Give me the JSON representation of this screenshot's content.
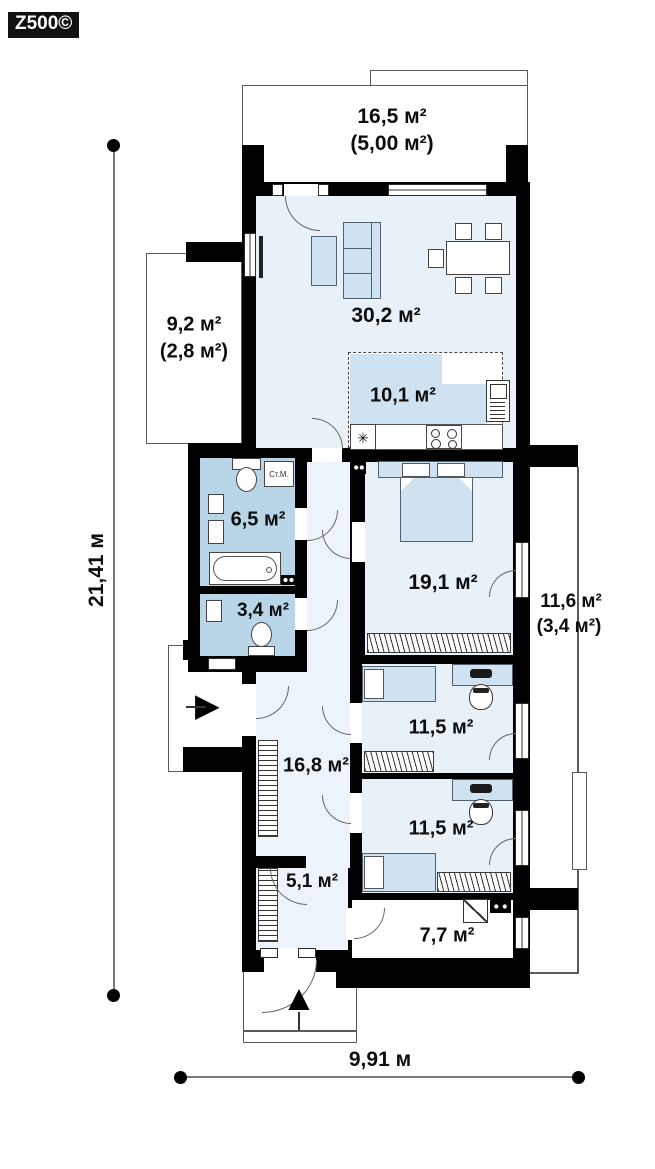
{
  "logo": {
    "text": "Z500©"
  },
  "dimensions": {
    "vertical": "21,41 м",
    "horizontal": "9,91 м"
  },
  "rooms": {
    "terrace_top": {
      "area": "16,5 м²",
      "area_secondary": "(5,00 м²)"
    },
    "terrace_left": {
      "area": "9,2 м²",
      "area_secondary": "(2,8 м²)"
    },
    "terrace_right": {
      "area": "11,6 м²",
      "area_secondary": "(3,4 м²)"
    },
    "living_room": {
      "area": "30,2 м²"
    },
    "kitchen": {
      "area": "10,1 м²"
    },
    "bathroom": {
      "area": "6,5 м²",
      "washing_machine": "Ст.М."
    },
    "wc": {
      "area": "3,4 м²"
    },
    "bedroom_main": {
      "area": "19,1 м²"
    },
    "bedroom_child_1": {
      "area": "11,5 м²"
    },
    "bedroom_child_2": {
      "area": "11,5 м²"
    },
    "hall": {
      "area": "16,8 м²"
    },
    "entry": {
      "area": "5,1 м²"
    },
    "utility": {
      "area": "7,7 м²"
    }
  },
  "icons": {
    "sink": "✳",
    "entrance_up": "▲",
    "entrance_side": "▶"
  },
  "colors": {
    "wall": "#000000",
    "room": "#e8f0f8",
    "bathroom": "#b9d6e9",
    "furniture": "#cfe2f1",
    "outline": "#5a5a5a"
  }
}
